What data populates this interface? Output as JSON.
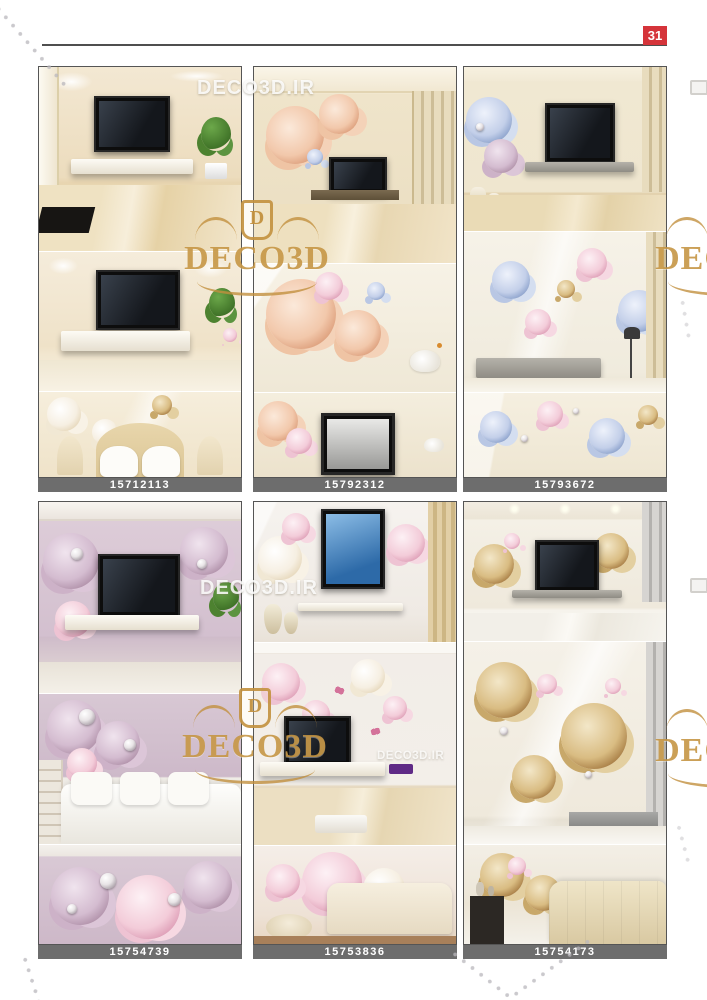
{
  "page": {
    "number": "31"
  },
  "brand": {
    "site_watermark": "DECO3D.IR",
    "crest_text": "DECO3D",
    "crest_monogram": "D"
  },
  "catalog": {
    "tiles": [
      {
        "code": "15712113"
      },
      {
        "code": "15792312"
      },
      {
        "code": "15793672"
      },
      {
        "code": "15754739"
      },
      {
        "code": "15753836"
      },
      {
        "code": "15754173"
      }
    ]
  },
  "colors": {
    "gold": "#c2903e",
    "code_bar": "#6d6d6d",
    "page_red": "#d5343a",
    "rule": "#4f4f4f"
  }
}
